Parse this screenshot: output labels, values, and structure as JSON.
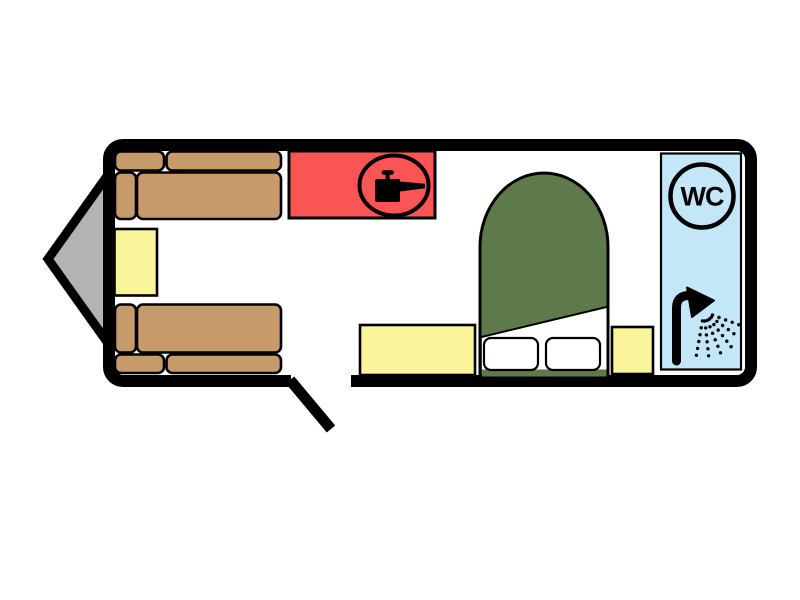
{
  "title": "Caravan floor plan",
  "labels": {
    "wc": "WC"
  },
  "colors": {
    "background": "#FFFFFF",
    "wall": "#000000",
    "floor": "#FFFFFF",
    "hitch": "#B3B3B3",
    "sofa": "#C79A6B",
    "furniture_yellow": "#FAF49B",
    "kitchen": "#FA5555",
    "bed": "#5E7A4A",
    "bathroom": "#C3E7F8",
    "pillow": "#FFFFFF",
    "icon": "#000000"
  },
  "icons": {
    "kitchen": "cooking-pot-icon",
    "toilet": "wc-roundel-icon",
    "shower": "shower-head-icon"
  },
  "rooms": [
    {
      "name": "front-lounge",
      "furniture": [
        "sofa",
        "table",
        "sofa"
      ]
    },
    {
      "name": "kitchen",
      "furniture": [
        "hob-unit"
      ]
    },
    {
      "name": "bedroom",
      "furniture": [
        "bedside-cabinet",
        "island-double-bed",
        "bedside-cabinet"
      ]
    },
    {
      "name": "washroom",
      "furniture": [
        "wc",
        "shower"
      ]
    }
  ]
}
